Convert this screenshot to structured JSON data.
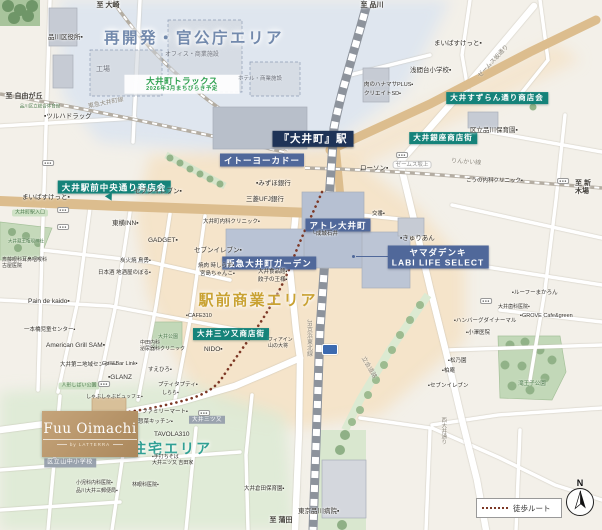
{
  "areas": {
    "redevelopment": "再開発・官公庁エリア",
    "station_commercial": "駅前商業エリア",
    "residential": "住宅エリア"
  },
  "brand": {
    "name": "Fuu Oimachi",
    "subtitle": "by LATTERRA"
  },
  "legend": {
    "walk_route": "徒歩ルート"
  },
  "compass": {
    "north": "N"
  },
  "map": {
    "labels": [
      {
        "t": "再開発・官公庁エリア",
        "x": 194,
        "y": 39,
        "k": "areaBlue",
        "n": "area-title-redevelopment"
      },
      {
        "t": "駅前商業エリア",
        "x": 258,
        "y": 301,
        "k": "areaGold",
        "n": "area-title-commercial"
      },
      {
        "t": "住宅エリア",
        "x": 172,
        "y": 449,
        "k": "areaTeal",
        "n": "area-title-residential"
      },
      {
        "t": "『大井町』駅",
        "x": 313,
        "y": 139,
        "k": "navyDark",
        "n": "station-badge-oimachi"
      },
      {
        "t": "イトーヨーカドー",
        "x": 262,
        "y": 160,
        "k": "navy",
        "fs": 8.5,
        "n": "facility-badge-itoyokado"
      },
      {
        "t": "アトレ大井町",
        "x": 338,
        "y": 225,
        "k": "navy",
        "n": "facility-badge-atre"
      },
      {
        "t": "阪急大井町ガーデン",
        "x": 269,
        "y": 263,
        "k": "navy",
        "n": "facility-badge-hankyu"
      },
      {
        "t": "ヤマダデンキ\nLABI LIFE SELECT",
        "x": 438,
        "y": 257,
        "k": "navy",
        "n": "facility-badge-yamada"
      },
      {
        "t": "大井駅前中央通り商店会",
        "x": 114,
        "y": 187,
        "k": "teal",
        "n": "shopping-street-badge-chuo"
      },
      {
        "t": "大井すずらん通り商店会",
        "x": 497,
        "y": 98,
        "k": "teal",
        "fs": 7.5,
        "n": "shopping-street-badge-suzuran"
      },
      {
        "t": "大井銀座商店街",
        "x": 443,
        "y": 138,
        "k": "teal",
        "fs": 7.5,
        "n": "shopping-street-badge-ginza"
      },
      {
        "t": "大井三ツ又商店街",
        "x": 231,
        "y": 334,
        "k": "teal",
        "fs": 7.5,
        "n": "shopping-street-badge-mitsumata"
      },
      {
        "t": "大井三ツ又",
        "x": 207,
        "y": 420,
        "k": "grayb",
        "n": "crossing-badge-mitsumata"
      },
      {
        "t": "区立山中小学校",
        "x": 70,
        "y": 463,
        "k": "grayb",
        "fs": 6,
        "n": "school-badge-yamanaka"
      },
      {
        "t": "大井町トラックス\n2026年3月まちびらき予定",
        "x": 182,
        "y": 84,
        "k": "greenbox",
        "n": "development-note-tracks"
      },
      {
        "t": "大井町駅入口",
        "x": 30,
        "y": 213,
        "k": "greenpill",
        "n": "entrance-badge"
      },
      {
        "t": "人形しばい公園",
        "x": 79,
        "y": 386,
        "k": "greenpill",
        "n": "park-badge"
      },
      {
        "t": "ゼームス坂上",
        "x": 412,
        "y": 165,
        "k": "whitepill",
        "n": "intersection-label"
      },
      {
        "t": "至 大崎",
        "x": 108,
        "y": 6,
        "k": "dest",
        "n": "direction-label-osaki"
      },
      {
        "t": "至 品川",
        "x": 372,
        "y": 6,
        "k": "dest",
        "n": "direction-label-shinagawa"
      },
      {
        "t": "至 自由が丘",
        "x": 24,
        "y": 97,
        "k": "dest",
        "n": "direction-label-jiyugaoka"
      },
      {
        "t": "至 新木場",
        "x": 584,
        "y": 188,
        "k": "dest",
        "n": "direction-label-shinkiba"
      },
      {
        "t": "至 蒲田",
        "x": 281,
        "y": 521,
        "k": "dest",
        "n": "direction-label-kamata"
      },
      {
        "t": "東急大井町線",
        "x": 106,
        "y": 104,
        "k": "roadlbl",
        "r": -11,
        "n": "railway-label-oimachi-line"
      },
      {
        "t": "ゼームス坂通り",
        "x": 494,
        "y": 62,
        "k": "roadlbl",
        "r": -47,
        "n": "road-label-jamessaka"
      },
      {
        "t": "りんかい線",
        "x": 466,
        "y": 163,
        "k": "roadlbl",
        "r": 4,
        "n": "railway-label-rinkai"
      },
      {
        "t": "立会道路",
        "x": 368,
        "y": 368,
        "k": "roadlbl",
        "r": 60,
        "n": "road-label-tachiai"
      },
      {
        "t": "JR京浜東北線",
        "x": 308,
        "y": 338,
        "k": "raillbl",
        "n": "railway-label-keihin-tohoku"
      },
      {
        "t": "西大井通り",
        "x": 443,
        "y": 431,
        "k": "raillbl",
        "fs": 5.5,
        "n": "road-label-nishioi"
      },
      {
        "t": "滝王子公園",
        "x": 532,
        "y": 384,
        "k": "parkname",
        "n": "park-label-takioji"
      },
      {
        "t": "大井公園",
        "x": 168,
        "y": 338,
        "k": "parkname",
        "fs": 5,
        "n": "park-label-oi"
      },
      {
        "t": "大井蔵王権現神社",
        "x": 26,
        "y": 241,
        "k": "parkname",
        "fs": 4.5,
        "n": "shrine-label"
      },
      {
        "t": "品川区立総合体育館",
        "x": 40,
        "y": 106,
        "k": "parkname",
        "fs": 4.5,
        "n": "gym-label"
      },
      {
        "t": "工場",
        "x": 96,
        "y": 66,
        "k": "bldg",
        "n": "building-label-factory"
      },
      {
        "t": "オフィス・商業施設",
        "x": 165,
        "y": 52,
        "k": "bldg",
        "fs": 6,
        "n": "building-label-office"
      },
      {
        "t": "ホテル・商業施設",
        "x": 238,
        "y": 76,
        "k": "bldg",
        "fs": 5.5,
        "n": "building-label-hotel"
      },
      {
        "t": "品川区役所▪",
        "x": 48,
        "y": 34,
        "k": "poi"
      },
      {
        "t": "▪ツルハドラッグ",
        "x": 44,
        "y": 113,
        "k": "poi"
      },
      {
        "t": "まいばすけっと▪",
        "x": 22,
        "y": 194,
        "k": "poi"
      },
      {
        "t": "セブンイレブン▪",
        "x": 134,
        "y": 188,
        "k": "poi"
      },
      {
        "t": "東横INN▪",
        "x": 112,
        "y": 220,
        "k": "poi"
      },
      {
        "t": "GADGET▪",
        "x": 148,
        "y": 237,
        "k": "poi"
      },
      {
        "t": "大井町内科クリニック▪",
        "x": 203,
        "y": 219,
        "k": "poi",
        "fs": 5.5
      },
      {
        "t": "セブンイレブン▪",
        "x": 194,
        "y": 247,
        "k": "poi"
      },
      {
        "t": "炭火焼 鳥勇▪",
        "x": 120,
        "y": 258,
        "k": "poi",
        "fs": 5.5
      },
      {
        "t": "日本酒 地酒屋のぼる▪",
        "x": 98,
        "y": 270,
        "k": "poi",
        "fs": 5.5
      },
      {
        "t": "焼肉 時しらず▪",
        "x": 198,
        "y": 263,
        "k": "poi",
        "fs": 5.5
      },
      {
        "t": "宮島ちゃんこ▪",
        "x": 200,
        "y": 271,
        "k": "poi",
        "fs": 5.5
      },
      {
        "t": "斎藤眼科耳鼻咽喉科\n古屋医院",
        "x": 2,
        "y": 258,
        "k": "poi",
        "fs": 5
      },
      {
        "t": "Pain de kaido▪",
        "x": 28,
        "y": 298,
        "k": "poi"
      },
      {
        "t": "一本橋児童センター▪",
        "x": 24,
        "y": 327,
        "k": "poi",
        "fs": 5.5
      },
      {
        "t": "American Grill SAM▪",
        "x": 46,
        "y": 342,
        "k": "poi"
      },
      {
        "t": "大井第二地域センター▪",
        "x": 60,
        "y": 362,
        "k": "poi",
        "fs": 5.5
      },
      {
        "t": "Grill&Bar Link▪",
        "x": 102,
        "y": 361,
        "k": "poi",
        "fs": 5.5
      },
      {
        "t": "▪GLANZ",
        "x": 108,
        "y": 374,
        "k": "poi"
      },
      {
        "t": "すえひろ▪",
        "x": 148,
        "y": 367,
        "k": "poi",
        "fs": 5.5
      },
      {
        "t": "中田内科\n泌尿器科クリニック",
        "x": 140,
        "y": 341,
        "k": "poi",
        "fs": 5
      },
      {
        "t": "NIDO▪",
        "x": 204,
        "y": 346,
        "k": "poi"
      },
      {
        "t": "プティタプティ▪",
        "x": 158,
        "y": 382,
        "k": "poi",
        "fs": 5.5
      },
      {
        "t": "しらら▪",
        "x": 162,
        "y": 391,
        "k": "poi",
        "fs": 5
      },
      {
        "t": "しゃぶしゃぶビュッフェ▪",
        "x": 86,
        "y": 395,
        "k": "poi",
        "fs": 5
      },
      {
        "t": "ファミリーマート▪",
        "x": 142,
        "y": 409,
        "k": "poi",
        "fs": 5.5
      },
      {
        "t": "惣菜キッチン▪",
        "x": 138,
        "y": 419,
        "k": "poi",
        "fs": 5.5
      },
      {
        "t": "TAVOLA310",
        "x": 154,
        "y": 431,
        "k": "poi"
      },
      {
        "t": "▪手打ちそば\n大井三ツ又 吉田家",
        "x": 152,
        "y": 455,
        "k": "poi",
        "fs": 5
      },
      {
        "t": "小児科内科医院▪",
        "x": 76,
        "y": 481,
        "k": "poi",
        "fs": 5
      },
      {
        "t": "品川大井三郵便局▪",
        "x": 76,
        "y": 489,
        "k": "poi",
        "fs": 5
      },
      {
        "t": "林眼科医院▪",
        "x": 132,
        "y": 483,
        "k": "poi",
        "fs": 5
      },
      {
        "t": "大井倉田保育園▪",
        "x": 244,
        "y": 486,
        "k": "poi",
        "fs": 5.5
      },
      {
        "t": "東京品川病院▪",
        "x": 298,
        "y": 508,
        "k": "poi"
      },
      {
        "t": "ローソン▪",
        "x": 360,
        "y": 165,
        "k": "poi"
      },
      {
        "t": "▪みずほ銀行",
        "x": 256,
        "y": 180,
        "k": "poi"
      },
      {
        "t": "三菱UFJ銀行",
        "x": 246,
        "y": 196,
        "k": "poi"
      },
      {
        "t": "└成城石井",
        "x": 312,
        "y": 231,
        "k": "poi",
        "fs": 5.5
      },
      {
        "t": "交番▪",
        "x": 372,
        "y": 211,
        "k": "poi",
        "fs": 5.5
      },
      {
        "t": "▪きゅりあん",
        "x": 400,
        "y": 235,
        "k": "poi"
      },
      {
        "t": "まいばすけっと▪",
        "x": 434,
        "y": 40,
        "k": "poi"
      },
      {
        "t": "浅間台小学校▪",
        "x": 410,
        "y": 67,
        "k": "poi"
      },
      {
        "t": "肉のハナマサPLUS▪",
        "x": 364,
        "y": 82,
        "k": "poi",
        "fs": 5.5
      },
      {
        "t": "クリエイトSD▪",
        "x": 364,
        "y": 91,
        "k": "poi",
        "fs": 5.5
      },
      {
        "t": "区立品川保育園▪",
        "x": 470,
        "y": 127,
        "k": "poi"
      },
      {
        "t": "こうの内科クリニック▪",
        "x": 466,
        "y": 178,
        "k": "poi",
        "fs": 5.5
      },
      {
        "t": "▪ルーフーまかろん",
        "x": 512,
        "y": 290,
        "k": "poi",
        "fs": 5.5
      },
      {
        "t": "大井歯科医院▪",
        "x": 498,
        "y": 305,
        "k": "poi",
        "fs": 5
      },
      {
        "t": "▪GROVE Cafe&green",
        "x": 520,
        "y": 313,
        "k": "poi",
        "fs": 5.5
      },
      {
        "t": "▪ハンバーグダイナーマル",
        "x": 454,
        "y": 318,
        "k": "poi",
        "fs": 5.5
      },
      {
        "t": "▪小澤医院",
        "x": 466,
        "y": 330,
        "k": "poi",
        "fs": 5.5
      },
      {
        "t": "▪松乃園",
        "x": 448,
        "y": 358,
        "k": "poi",
        "fs": 5.5
      },
      {
        "t": "▪柏庵",
        "x": 442,
        "y": 368,
        "k": "poi",
        "fs": 5.5
      },
      {
        "t": "▪セブンイレブン",
        "x": 428,
        "y": 383,
        "k": "poi",
        "fs": 5.5
      },
      {
        "t": "大井食品館▪",
        "x": 258,
        "y": 269,
        "k": "poi",
        "fs": 5.5
      },
      {
        "t": "餃子の王様▪",
        "x": 258,
        "y": 277,
        "k": "poi",
        "fs": 5.5
      },
      {
        "t": "▪CAFE310",
        "x": 186,
        "y": 313,
        "k": "poi",
        "fs": 5.5
      },
      {
        "t": "フィアイン\n山の大将",
        "x": 268,
        "y": 338,
        "k": "poi",
        "fs": 5
      },
      {
        "t": "●●●",
        "x": 48,
        "y": 163,
        "k": "signal",
        "n": "traffic-signal-icon"
      },
      {
        "t": "●●●",
        "x": 63,
        "y": 210,
        "k": "signal",
        "n": "traffic-signal-icon"
      },
      {
        "t": "●●●",
        "x": 63,
        "y": 227,
        "k": "signal",
        "n": "traffic-signal-icon"
      },
      {
        "t": "●●●",
        "x": 402,
        "y": 155,
        "k": "signal",
        "n": "traffic-signal-icon"
      },
      {
        "t": "●●●",
        "x": 563,
        "y": 181,
        "k": "signal",
        "n": "traffic-signal-icon"
      },
      {
        "t": "●●●",
        "x": 104,
        "y": 384,
        "k": "signal",
        "n": "traffic-signal-icon"
      },
      {
        "t": "●●●",
        "x": 204,
        "y": 413,
        "k": "signal",
        "n": "traffic-signal-icon"
      },
      {
        "t": "●●●",
        "x": 486,
        "y": 301,
        "k": "signal",
        "n": "traffic-signal-icon"
      }
    ]
  }
}
